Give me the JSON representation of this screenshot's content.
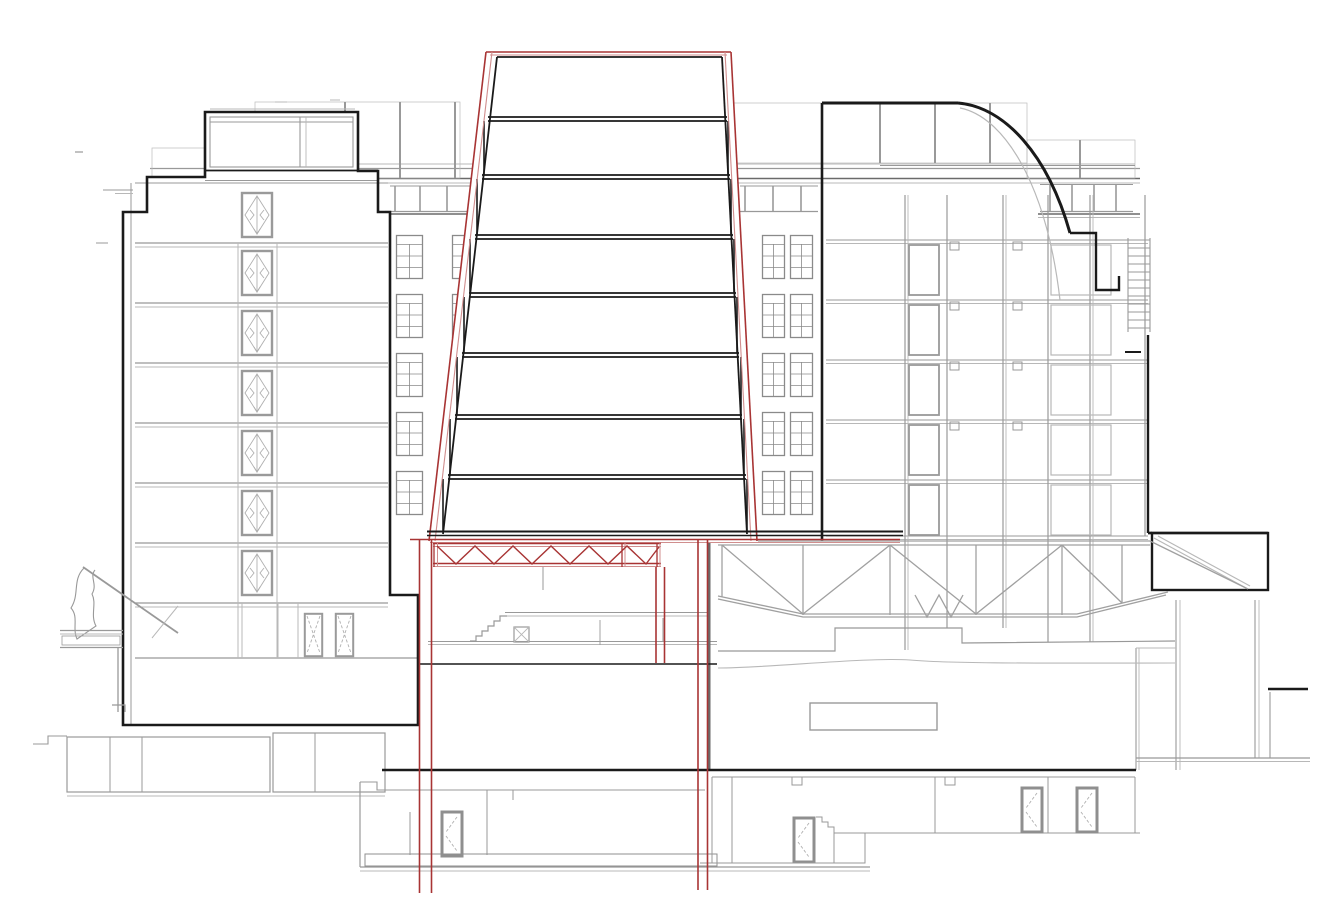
{
  "page": {
    "background": "#ffffff"
  },
  "drawing": {
    "kind": "architectural cross-section",
    "visible_text": [],
    "colors": {
      "paper": "#ffffff",
      "cut_outline": "#1a1a1a",
      "existing_lines_dark": "#6a6a6a",
      "existing_lines": "#999999",
      "existing_lines_light": "#b8b8b8",
      "proposal_red": "#a83434",
      "proposal_red_light": "#d08e8e"
    },
    "left_building": {
      "floor_count": 8,
      "elevator_doors": 7,
      "ground_double_doors": 2,
      "penthouse": true,
      "roof_balustrade": true,
      "flagpole": true,
      "entrance_canopy": true
    },
    "center_tower": {
      "levels": 8,
      "tapered_outline": true,
      "outline_color_key": "proposal_red",
      "transfer_truss_bays": 6,
      "red_column_pairs": 3
    },
    "right_building": {
      "floor_count": 6,
      "roof_louvres": true,
      "curved_roof_edge": true,
      "access_ladder": true,
      "cantilever_truss": true,
      "clerestory_mullions": 4
    },
    "lower_levels": {
      "auditorium_hall": true,
      "stage_recess": true,
      "stair_flight_steps": 6,
      "basement_levels": 2,
      "beam_strip": true,
      "basement_doors": 5,
      "window_grid_columns": 4,
      "window_grid_rows": 5
    }
  }
}
